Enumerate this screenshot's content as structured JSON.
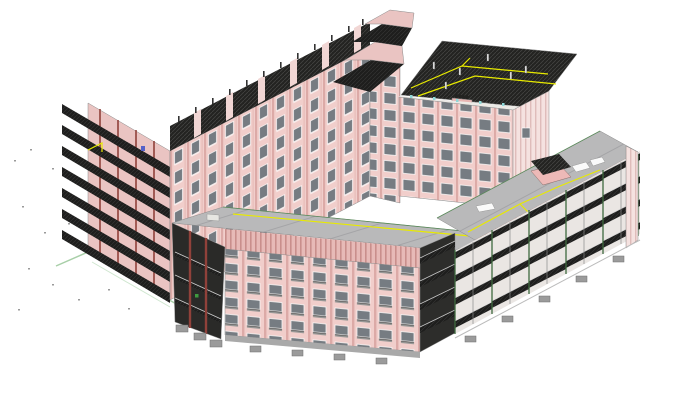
{
  "scene": {
    "type": "bim-3d-isometric-view",
    "description_visible_text": "",
    "buildings": {
      "rear_wing": {
        "name": "rear-wing",
        "floors": 8,
        "features": [
          "pink striped facade",
          "window grid",
          "rooftop terrace band with dark hatched floors",
          "stacked dark balcony slabs on west gable",
          "railing posts on roofline"
        ]
      },
      "tower": {
        "name": "rear-tower",
        "floors": 6,
        "features": [
          "dark hatched flat roof",
          "yellow safety lines",
          "rooftop posts",
          "pink equipment",
          "window grid facade"
        ]
      },
      "front_wing": {
        "name": "front-wing",
        "floors": 5,
        "features": [
          "grey roof with seams",
          "yellow edge lines",
          "pink facade with balcony windows",
          "sectioned open west end with dark floor slabs",
          "foundation footings"
        ]
      },
      "right_wing": {
        "name": "right-wing-under-construction",
        "floors": 4,
        "features": [
          "open structure bays",
          "dark hatched floor slabs",
          "slender posts",
          "grey roof",
          "rooftop penthouse",
          "white vehicles on roof",
          "yellow safety lines",
          "foundation footings"
        ]
      }
    },
    "markers": [
      {
        "name": "blue-marker"
      },
      {
        "name": "green-marker"
      },
      {
        "name": "yellow-rooftop-lines"
      },
      {
        "name": "site-survey-dots"
      }
    ]
  },
  "colors": {
    "background": "#ffffff",
    "wallPink": "#f1cecb",
    "wallPinkShade": "#eac4c2",
    "parapetPink": "#e7bab7",
    "stripePink": "#dcaaa7",
    "accentRed": "#90413a",
    "windowGlass": "#767c82",
    "windowFrame": "#ffffff",
    "slabDark": "#232321",
    "slabDarker": "#1e1e1d",
    "hatchLine": "#5a5a58",
    "roofGray": "#b9b9ba",
    "roofSeam": "#9d9da0",
    "parapetLight": "#eceae6",
    "endFaceLight": "#f0ebe9",
    "bayGapLight": "#eae6e3",
    "safetyYellow": "#e8ea00",
    "postGreen": "#3f6a3f",
    "markerGreen": "#3f9a3f",
    "groundGreen": "#a8cfa8",
    "cyanTick": "#8fd8d8",
    "markerBlue": "#5560c8",
    "footingGray": "#9b9b9b",
    "footingEdge": "#6f6f6f",
    "whiteObject": "#fafafa",
    "edgeGray": "#8a8a8a"
  }
}
